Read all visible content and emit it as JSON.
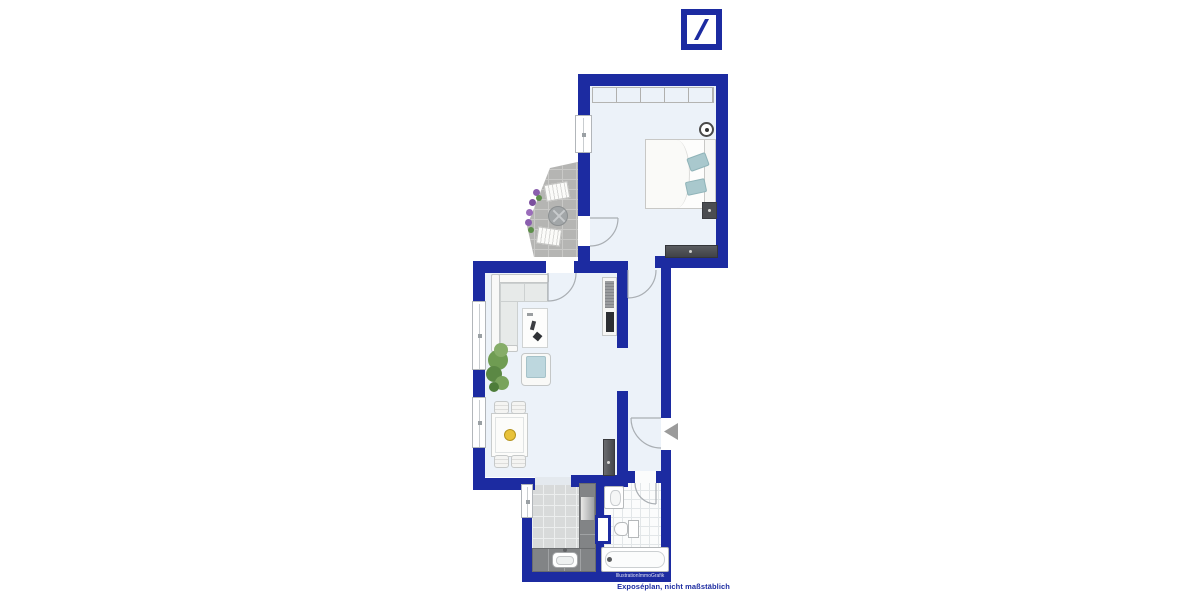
{
  "branding": {
    "logo_name": "deutsche-bank-logo",
    "brand_color": "#1c2ba1"
  },
  "plan": {
    "type": "apartment-floor-plan",
    "wall_color": "#1c2ba1",
    "rooms": [
      "bedroom",
      "balcony",
      "living-room",
      "hallway",
      "kitchen",
      "bathroom"
    ],
    "watermark": "IllustrationImmoGrafik"
  },
  "footer": {
    "disclaimer": "Exposéplan, nicht maßstäblich"
  }
}
